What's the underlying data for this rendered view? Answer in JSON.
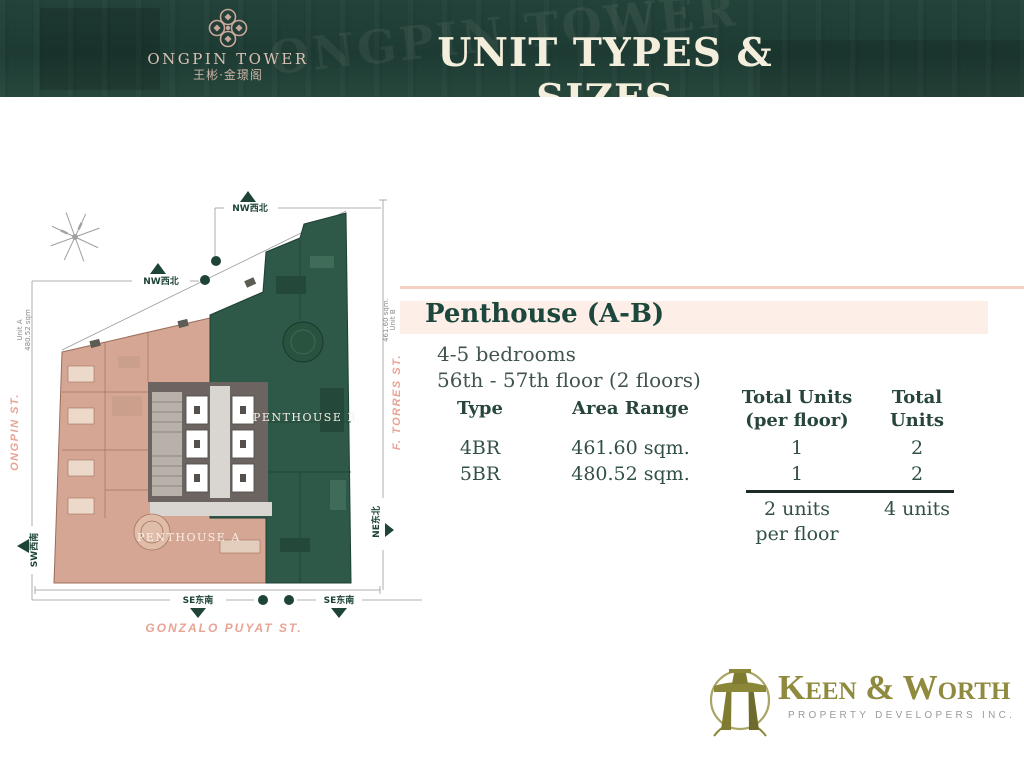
{
  "header": {
    "brand_name": "ONGPIN TOWER",
    "brand_chinese": "王彬·金璟阁",
    "title": "UNIT TYPES & SIZES",
    "watermark": "ONGPIN TOWER"
  },
  "panel": {
    "heading": "Penthouse (A-B)",
    "bedrooms": "4-5 bedrooms",
    "floors": "56th - 57th floor (2 floors)"
  },
  "unit_table": {
    "headers": {
      "type": "Type",
      "area": "Area Range",
      "per_floor_line1": "Total Units",
      "per_floor_line2": "(per floor)",
      "total_line1": "Total",
      "total_line2": "Units"
    },
    "rows": [
      {
        "type": "4BR",
        "area": "461.60 sqm.",
        "per_floor": "1",
        "total": "2"
      },
      {
        "type": "5BR",
        "area": "480.52 sqm.",
        "per_floor": "1",
        "total": "2"
      }
    ],
    "totals": {
      "per_floor_line1": "2 units",
      "per_floor_line2": "per floor",
      "total": "4 units"
    }
  },
  "floorplan": {
    "unit_a_label": "PENTHOUSE A",
    "unit_b_label": "PENTHOUSE B",
    "streets": {
      "ongpin": "ONGPIN ST.",
      "torres": "F. TORRES ST.",
      "gonzalo": "GONZALO PUYAT ST."
    },
    "markers": {
      "nw1": "NW西北",
      "nw2": "NW西北",
      "sw": "SW西南",
      "ne": "NE东北",
      "se1": "SE东南",
      "se2": "SE东南"
    },
    "dimensions": {
      "unit_a_line1": "Unit A",
      "unit_a_line2": "480.52 sqm",
      "unit_b_line1": "461.60 sqm.",
      "unit_b_line2": "Unit B"
    }
  },
  "footer": {
    "company": "Keen & Worth",
    "tagline": "PROPERTY DEVELOPERS INC."
  },
  "colors": {
    "header_green": "#1d3b33",
    "accent_green": "#1c473c",
    "bar_pink": "#fdeee7",
    "plan_pink": "#d5a693",
    "plan_green": "#2e5847",
    "street_pink": "#e8a495",
    "logo_olive": "#8f8a3e"
  }
}
